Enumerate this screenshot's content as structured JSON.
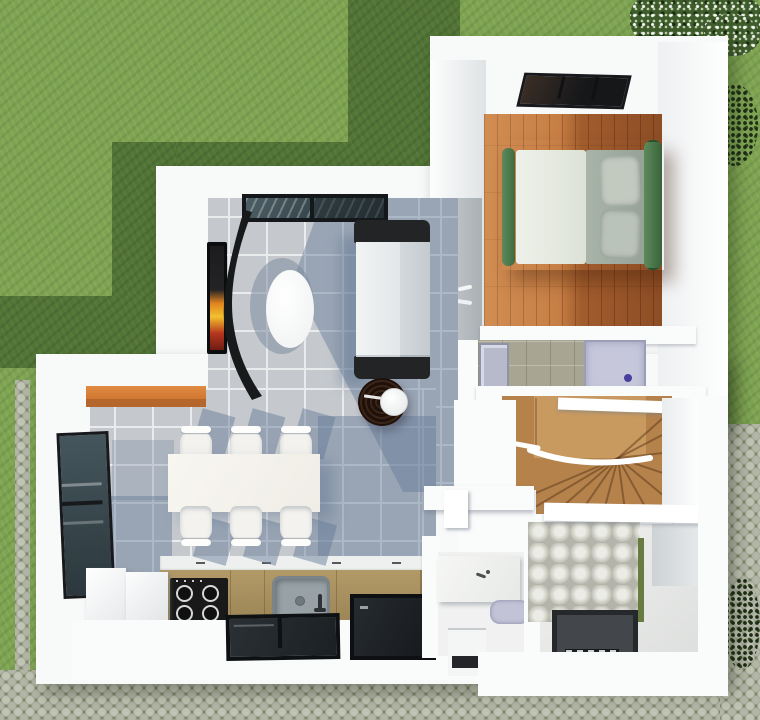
{
  "scene": {
    "type": "3d-floor-plan-render",
    "description": "Top-down 3D architectural render of a small two-storey house ground floor surrounded by a lawn and cobblestone paths",
    "rooms": [
      {
        "id": "living-room",
        "label": "Living room",
        "floor": "grey ceramic tile"
      },
      {
        "id": "kitchen-dining",
        "label": "Kitchen and dining area",
        "floor": "grey ceramic tile"
      },
      {
        "id": "bedroom",
        "label": "Bedroom",
        "floor": "warm hardwood planks"
      },
      {
        "id": "ensuite-bathroom",
        "label": "En-suite bathroom",
        "floor": "olive mosaic tile"
      },
      {
        "id": "staircase",
        "label": "Wooden winder staircase",
        "floor": "oak treads"
      },
      {
        "id": "powder-room",
        "label": "Entry washroom",
        "floor": "white screed"
      },
      {
        "id": "main-bathroom",
        "label": "Main bathroom",
        "floor": "light screed with textured feature wall"
      }
    ],
    "furniture": {
      "bed": "Double bed with green frame, grey duvet and two pillows",
      "sofa": "Two-seat sofa with dark armrests",
      "coffee_table": "White oval coffee table",
      "side_table": "Round dark-wood side table with white plate",
      "tv": "Wall TV with curved black media panel",
      "dining_table": "White dining table with six white chairs",
      "kitchen": "Tan kitchen counter with gas hob, sink and white fridge cabinets",
      "shower_ensuite": "Lavender shower tray with drain",
      "shower_main": "Dark grey walk-in shower tray with slatted drain",
      "vanity": "White washbasin counter",
      "toilet": "Compact toilet"
    },
    "outdoor": [
      "lawn",
      "house shadow on lawn",
      "cobblestone paths",
      "white flowering bush",
      "dark shrubs"
    ],
    "palette": {
      "grass": "#7ea451",
      "grass_shadow": "#527536",
      "cobblestone": "#a2a695",
      "wall_white": "#f8f9f9",
      "tile_grey": "#c5c9cd",
      "tile_shadow_blue": "#647a96",
      "wood_floor_light": "#c0763c",
      "wood_floor_dark": "#8f4f22",
      "stair_wood": "#b5824c",
      "counter_tan": "#a6905e",
      "accent_orange": "#d27c35",
      "bed_green": "#4c7a4a",
      "shower_lavender": "#c6c7db",
      "glass_dark": "#2b363b",
      "olive_tile": "#a8a692"
    }
  }
}
